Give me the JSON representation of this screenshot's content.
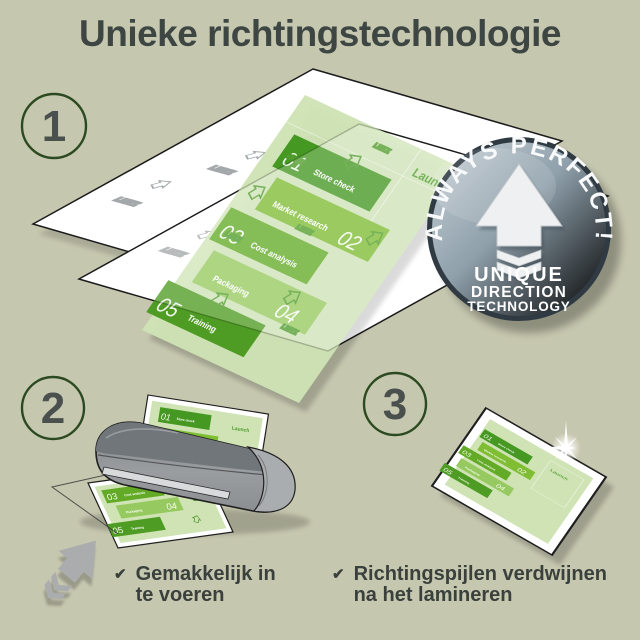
{
  "title": "Unieke richtingstechnologie",
  "steps": [
    {
      "number": "1"
    },
    {
      "number": "2"
    },
    {
      "number": "3"
    }
  ],
  "captions": [
    {
      "check_icon": "✔",
      "line1": "Gemakkelijk in",
      "line2": "te voeren"
    },
    {
      "check_icon": "✔",
      "line1": "Richtingspijlen verdwijnen",
      "line2": "na het lamineren"
    }
  ],
  "badge": {
    "arc_text": "ALWAYS PERFECT!",
    "line1": "UNIQUE",
    "line2": "DIRECTION",
    "line3": "TECHNOLOGY"
  },
  "doc": {
    "watermark": "LEITZ",
    "launch": "Launch",
    "items": [
      {
        "num": "01",
        "label": "Store check"
      },
      {
        "num": "02",
        "label": "Market research"
      },
      {
        "num": "03",
        "label": "Cost analysis"
      },
      {
        "num": "04",
        "label": "Packaging"
      },
      {
        "num": "05",
        "label": "Training"
      }
    ]
  },
  "colors": {
    "background": "#c6c7af",
    "title_text": "#3e4643",
    "step_circle_border": "#2c4a21",
    "green_dark": "#459821",
    "green_mid": "#63ab26",
    "green_light": "#96c95f",
    "doc_background": "#cfe3b5",
    "launch_green": "#4a9e28",
    "badge_face": "#75858f",
    "machine_gray": "#8d9194"
  }
}
